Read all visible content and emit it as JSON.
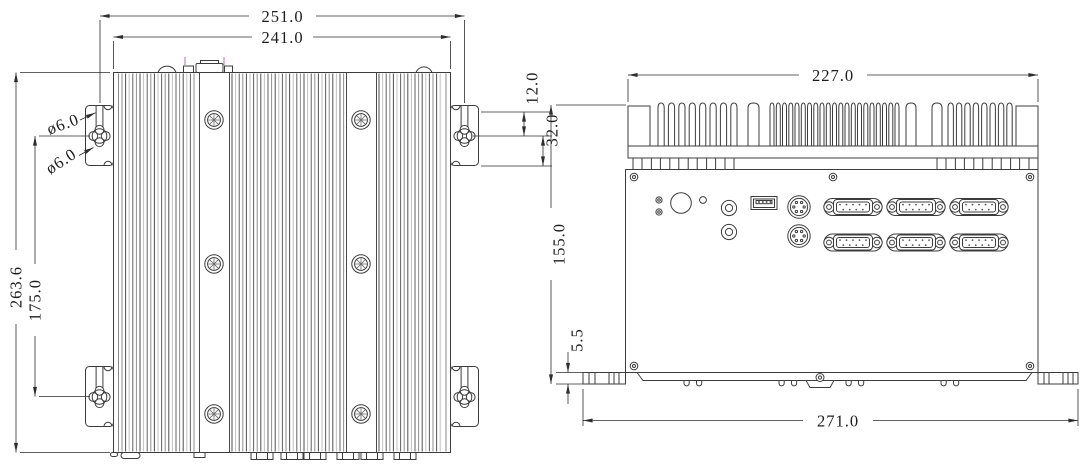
{
  "top_view": {
    "dims": {
      "w_overall": "251.0",
      "w_body": "241.0",
      "h_overall": "263.6",
      "h_hole_span": "175.0",
      "hole_dia_upper": "ø6.0",
      "hole_dia_lower": "ø6.0",
      "bracket_upper_offset": "12.0",
      "bracket_lower_offset": "32.0"
    }
  },
  "front_view": {
    "dims": {
      "w_heatsink": "227.0",
      "h_total": "155.0",
      "foot_height": "5.5",
      "w_total": "271.0"
    }
  },
  "style": {
    "background": "#ffffff",
    "line_color": "#3c3c3c",
    "dim_line_color": "#2e2e2e",
    "accent_tick_color": "#c87fd0"
  }
}
